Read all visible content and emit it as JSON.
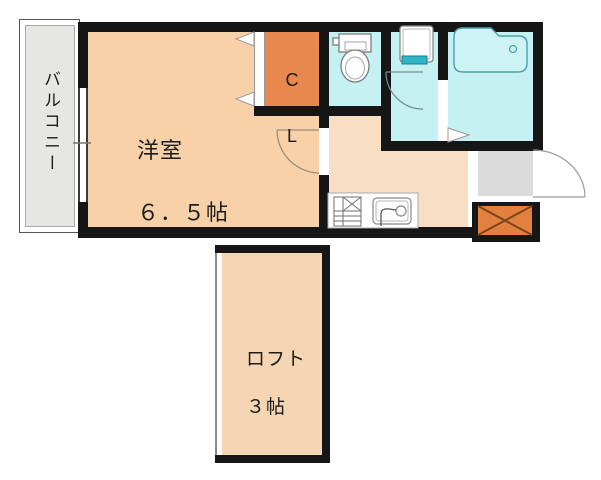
{
  "plan": {
    "type": "japanese-apartment-floor-plan",
    "balcony_label": "バルコニー",
    "main_room_label": "洋室",
    "main_room_size": "６．５帖",
    "closet_line1": "C",
    "closet_line2": "L",
    "loft_label": "ロフト",
    "loft_size": "３帖"
  },
  "rooms": [
    {
      "name": "balcony",
      "label": "バルコニー"
    },
    {
      "name": "western-room",
      "label": "洋室",
      "size_tatami": "６．５帖"
    },
    {
      "name": "closet",
      "label": "CL"
    },
    {
      "name": "toilet-room",
      "label": ""
    },
    {
      "name": "washroom",
      "label": ""
    },
    {
      "name": "bathroom",
      "label": ""
    },
    {
      "name": "kitchen-hall",
      "label": ""
    },
    {
      "name": "entrance",
      "label": ""
    },
    {
      "name": "loft",
      "label": "ロフト",
      "size_tatami": "３帖"
    }
  ],
  "fixtures": [
    "toilet",
    "washing-machine-pan",
    "bathtub",
    "gas-stove",
    "kitchen-sink",
    "balcony-window",
    "closet-folding-door",
    "room-door",
    "washroom-door",
    "bathroom-door",
    "entrance-door",
    "crossed-box-marker"
  ],
  "colors": {
    "wall": "#161616",
    "main_room": "#f8d1a9",
    "kitchen": "#f8dec3",
    "loft": "#f6d6b2",
    "closet_orange": "#e8884e",
    "crossed_box_orange": "#e2813f",
    "wet_area_cyan": "#c6f1f3",
    "balcony_gray": "#e6e6e4",
    "entrance_gray": "#dbdbdb",
    "teal_accent": "#2fb5c8"
  }
}
